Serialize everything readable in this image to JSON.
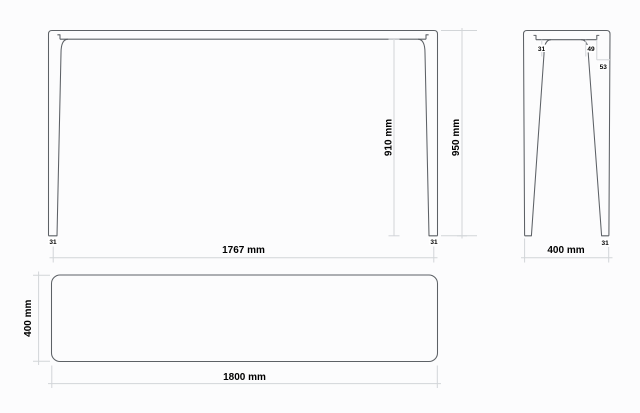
{
  "colors": {
    "outline": "#5d6166",
    "dimension_lines": "#d2d5d8",
    "text": "#000000",
    "background": "#fcfcfd"
  },
  "views": {
    "front": {
      "width": "1767 mm",
      "clearance": "910 mm",
      "height": "950 mm",
      "left_foot": "31",
      "right_foot": "31"
    },
    "side": {
      "top_a": "31",
      "top_b": "49",
      "top_c": "53",
      "depth": "400 mm",
      "foot": "31"
    },
    "plan": {
      "depth": "400 mm",
      "length": "1800 mm"
    }
  }
}
